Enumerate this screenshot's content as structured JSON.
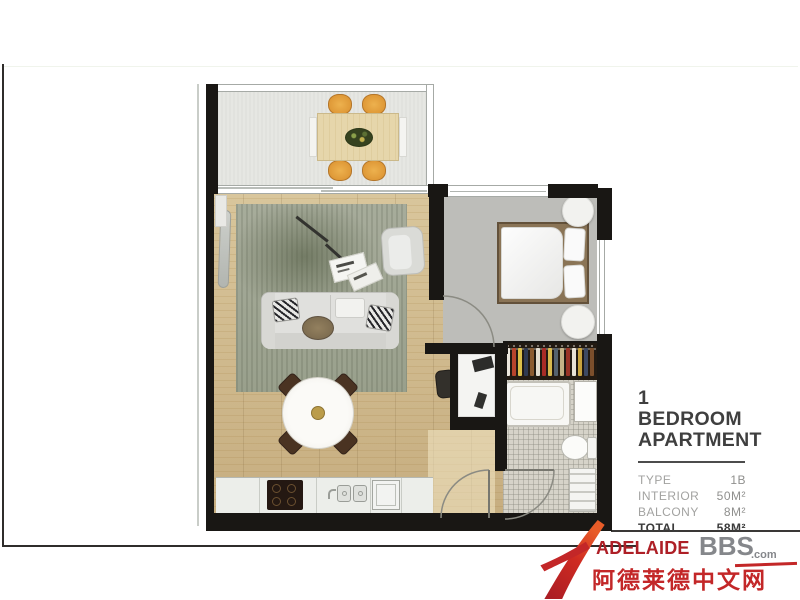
{
  "info_panel": {
    "title_line1": "1 BEDROOM",
    "title_line2": "APARTMENT",
    "specs_rows": [
      {
        "label": "TYPE",
        "value": "1B"
      },
      {
        "label": "INTERIOR",
        "value": "50M²"
      },
      {
        "label": "BALCONY",
        "value": "8M²"
      },
      {
        "label": "TOTAL",
        "value": "58M²"
      }
    ]
  },
  "watermark": {
    "brand_caps": "Adelaide",
    "brand_suffix": "BBS",
    "brand_tld": ".com",
    "tagline_cn": "阿德莱德中文网",
    "red": "#c02127",
    "gray": "#85878b"
  },
  "floorplan": {
    "wall_color": "#191714",
    "wood_floor_color": "#d6c196",
    "balcony_floor_color": "#e6e7e3",
    "bedroom_carpet_color": "#bdbdb9",
    "tile_color": "#d6d3c9",
    "rug_color": "#9aa08d",
    "wardrobe_clothes_colors": [
      "#ece7dd",
      "#b8442c",
      "#ddc04a",
      "#2f3a52",
      "#8a5a30",
      "#e3ddd1",
      "#a82c26",
      "#d8b94e",
      "#55626e",
      "#c4b286",
      "#993326",
      "#e8e2d6",
      "#caa43e",
      "#3e4a63",
      "#7c4f2c"
    ]
  }
}
